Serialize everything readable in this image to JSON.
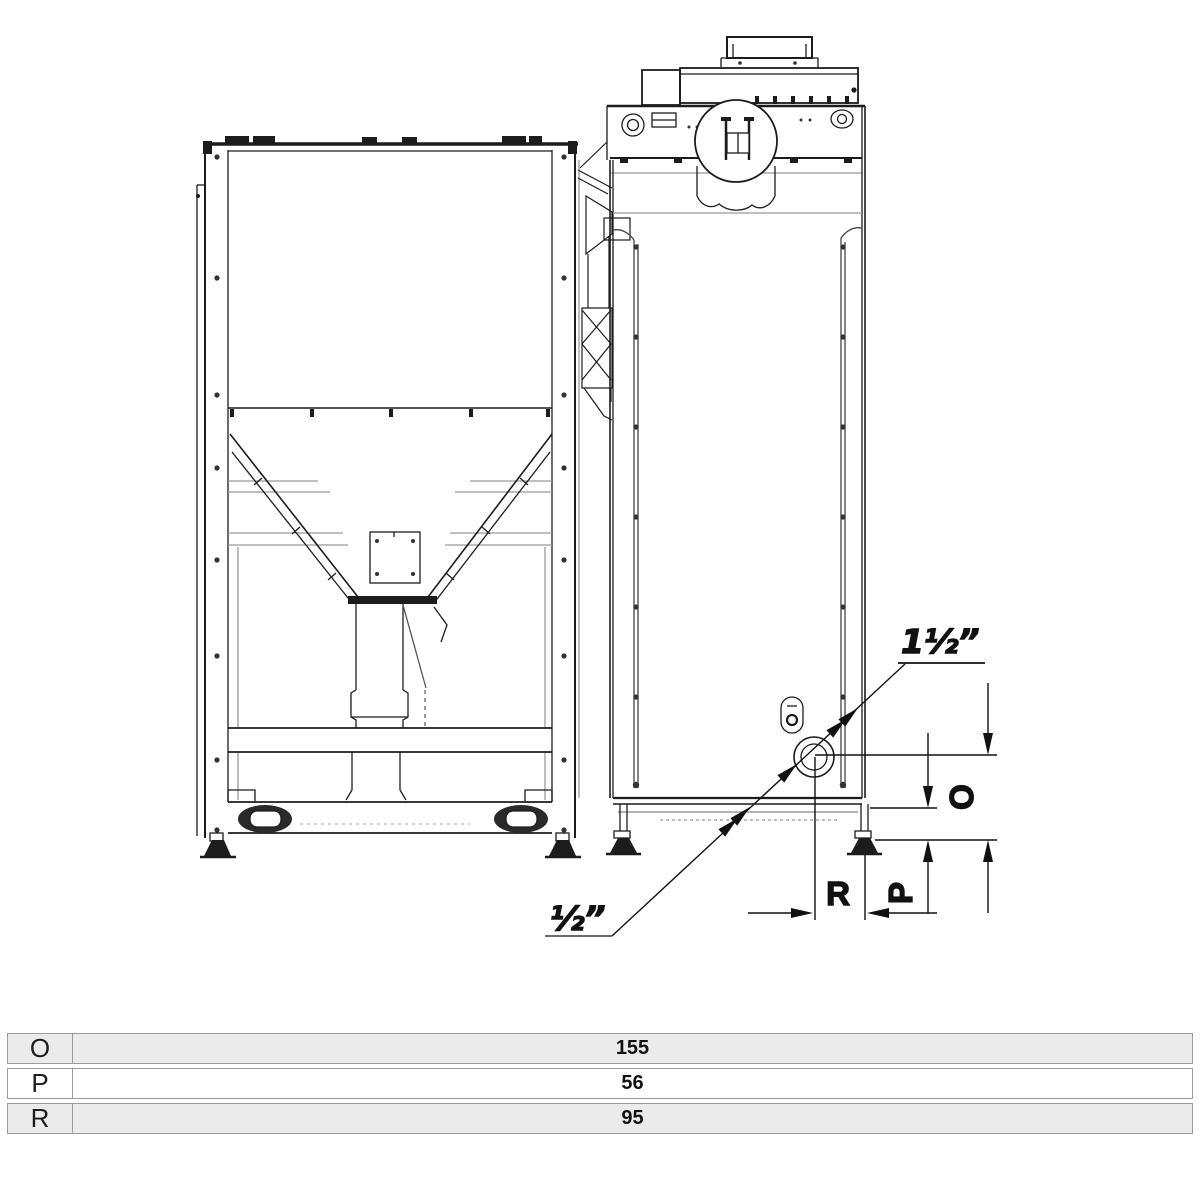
{
  "drawing": {
    "labels": {
      "fitting_top": "1½”",
      "fitting_bottom": "½”",
      "dim_o": "O",
      "dim_p": "P",
      "dim_r": "R"
    },
    "colors": {
      "line_dark": "#1c1c1c",
      "line_light": "#999999",
      "background": "#ffffff"
    }
  },
  "table": {
    "rows": [
      {
        "label": "O",
        "value": "155"
      },
      {
        "label": "P",
        "value": "56"
      },
      {
        "label": "R",
        "value": "95"
      }
    ],
    "row_colors": [
      "#ebebeb",
      "#ffffff",
      "#ebebeb"
    ],
    "border_color": "#9b9b9b"
  }
}
